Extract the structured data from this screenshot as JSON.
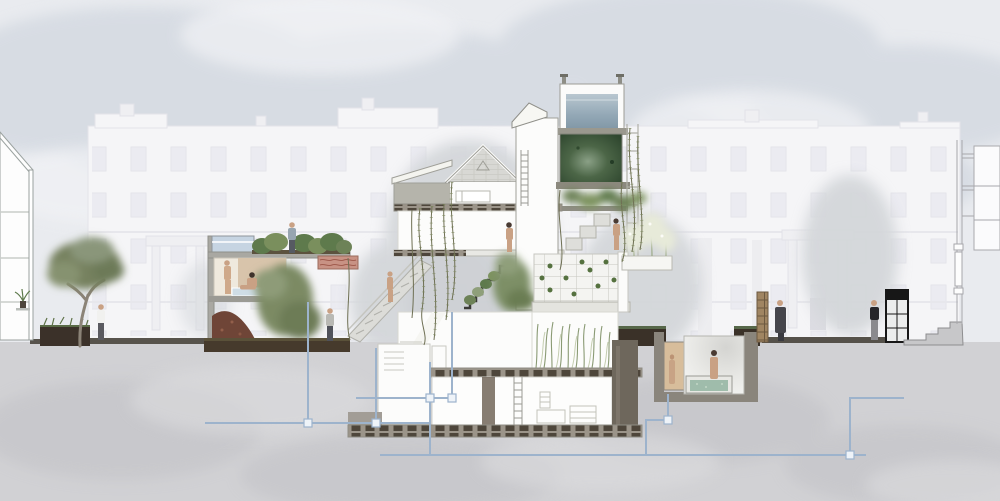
{
  "canvas": {
    "width": 1000,
    "height": 501
  },
  "scene": {
    "type": "architectural-section-illustration",
    "subject": "cut-away section through a terraced garden house with planted interiors, sunken bath and drainage, set against ghosted London terrace facades",
    "visible_text": [],
    "palette": {
      "sky": "#e9ebef",
      "cloud": "#c9d0da",
      "cloud_light": "#f1f2f5",
      "ghost_facade": "#f5f5f7",
      "ghost_line": "#e2e2e8",
      "ghost_window": "#e9e9ef",
      "background_tree": "#d4d7da",
      "ground_wash": "#d1d1d4",
      "pavement": "#57534c",
      "soil": "#463a2c",
      "soil_dark": "#3a3128",
      "soil_green_top": "#57684a",
      "foliage": "#76815f",
      "foliage_light": "#8a967a",
      "foliage_dark": "#5e7a4c",
      "vine": "#6e6f53",
      "leaf": "#7d8a5e",
      "trunk": "#8b8377",
      "wall_white": "#fcfcfb",
      "line_grey": "#9aa19f",
      "concrete": "#a9a8a2",
      "slab_joist": "#4e463b",
      "shingle": "#d8d8d4",
      "tank_water": "#c6d4e2",
      "roof_pool_water": "#93a8b6",
      "pool_pale": "#cfdde6",
      "moss_dark": "#2f472f",
      "moss_mid": "#4c6647",
      "moss_light": "#8aa086",
      "pipe_blue": "#9db3cc",
      "pipe_fill": "#eef3f8",
      "skin": "#c9a184",
      "hair": "#4a3b33",
      "coat_dark": "#46464c",
      "shirt_white": "#f1f1ef",
      "shirt_blue": "#97a5b0",
      "tee_black": "#26262a",
      "mural_red": "#b56a5e",
      "rubble": "#6f4537",
      "bath_water": "#9fbcab",
      "niche_tan": "#d7bd9b",
      "brick_pillar": "#a08562",
      "booth_black": "#171717"
    },
    "elements": [
      {
        "name": "sky-clouds",
        "label": "grey watercolour sky"
      },
      {
        "name": "ghost-terrace-facades",
        "label": "faded background terrace houses with windows, parapets, chimneys and porticos"
      },
      {
        "name": "background-trees",
        "label": "soft grey tree silhouettes behind facades"
      },
      {
        "name": "left-cut-neighbour",
        "label": "sectioned neighbouring house, left edge, with potted plant on bracket"
      },
      {
        "name": "street-tree",
        "label": "umbrella-canopy tree by left pavement"
      },
      {
        "name": "annex-pavilion",
        "label": "two-storey garden annex: water tank, roof garden, bathing room with pale pool, rubble room, red mural"
      },
      {
        "name": "external-stair",
        "label": "diagonal open stair linking annex to main house"
      },
      {
        "name": "main-house",
        "label": "sectioned main house: shingled gable roof, attic bedroom, steep tower with ladders"
      },
      {
        "name": "rooftop-pool",
        "label": "glass rooftop pool box with blue-grey water"
      },
      {
        "name": "moss-wall",
        "label": "large dark-green moss panel below rooftop pool"
      },
      {
        "name": "trellis",
        "label": "slender trellis frame with hanging vines"
      },
      {
        "name": "planted-stair",
        "label": "interior stair with cascading planters"
      },
      {
        "name": "grid-planter-terrace",
        "label": "gridded planting terrace with seedlings"
      },
      {
        "name": "flower-planters",
        "label": "white flowering shrubs in planter boxes"
      },
      {
        "name": "grass-room",
        "label": "lower room filled with tall grasses"
      },
      {
        "name": "light-shaft-room",
        "label": "lower room with diagonal light shaft and small stair"
      },
      {
        "name": "basement",
        "label": "deep basement room with ladder, shelving and furniture outlines"
      },
      {
        "name": "sunken-bath",
        "label": "buried plunge-bath chamber with painted niche figure"
      },
      {
        "name": "drainage-pipes",
        "label": "pale blue drainage pipe network underground"
      },
      {
        "name": "brick-pillar",
        "label": "speckled brick gate pier at right pavement"
      },
      {
        "name": "black-booth",
        "label": "black-framed glazed booth/door at right"
      },
      {
        "name": "right-garden-stairs",
        "label": "pavement steps up to right sectioned building"
      },
      {
        "name": "right-cut-building",
        "label": "thin sectioned building outline at far right"
      },
      {
        "name": "garden-beds",
        "label": "dark soil garden beds along ground line"
      },
      {
        "name": "underground-wash",
        "label": "grey watercolour earth below ground"
      }
    ],
    "figures": [
      {
        "id": "pedestrian-under-tree",
        "desc": "person in white shirt standing under street tree"
      },
      {
        "id": "roof-gardener",
        "desc": "person in blue-grey shirt on annex roof garden"
      },
      {
        "id": "bather-standing",
        "desc": "standing bather in annex bath room"
      },
      {
        "id": "bather-seated",
        "desc": "seated bather beside pale pool"
      },
      {
        "id": "rubble-room-visitor",
        "desc": "clothed figure beside shrub in annex lower room"
      },
      {
        "id": "stair-climber",
        "desc": "unclothed figure climbing external stair"
      },
      {
        "id": "upper-room-figure",
        "desc": "unclothed figure in main-house upper room"
      },
      {
        "id": "terrace-figure",
        "desc": "unclothed figure by flowering planters"
      },
      {
        "id": "plunge-bath-figure",
        "desc": "figure standing in sunken plunge bath"
      },
      {
        "id": "painted-niche-figure",
        "desc": "painted figure in tan wall niche"
      },
      {
        "id": "pedestrian-long-coat",
        "desc": "pedestrian in long dark coat, right pavement"
      },
      {
        "id": "pedestrian-black-shirt",
        "desc": "pedestrian in black shirt near booth"
      }
    ]
  }
}
